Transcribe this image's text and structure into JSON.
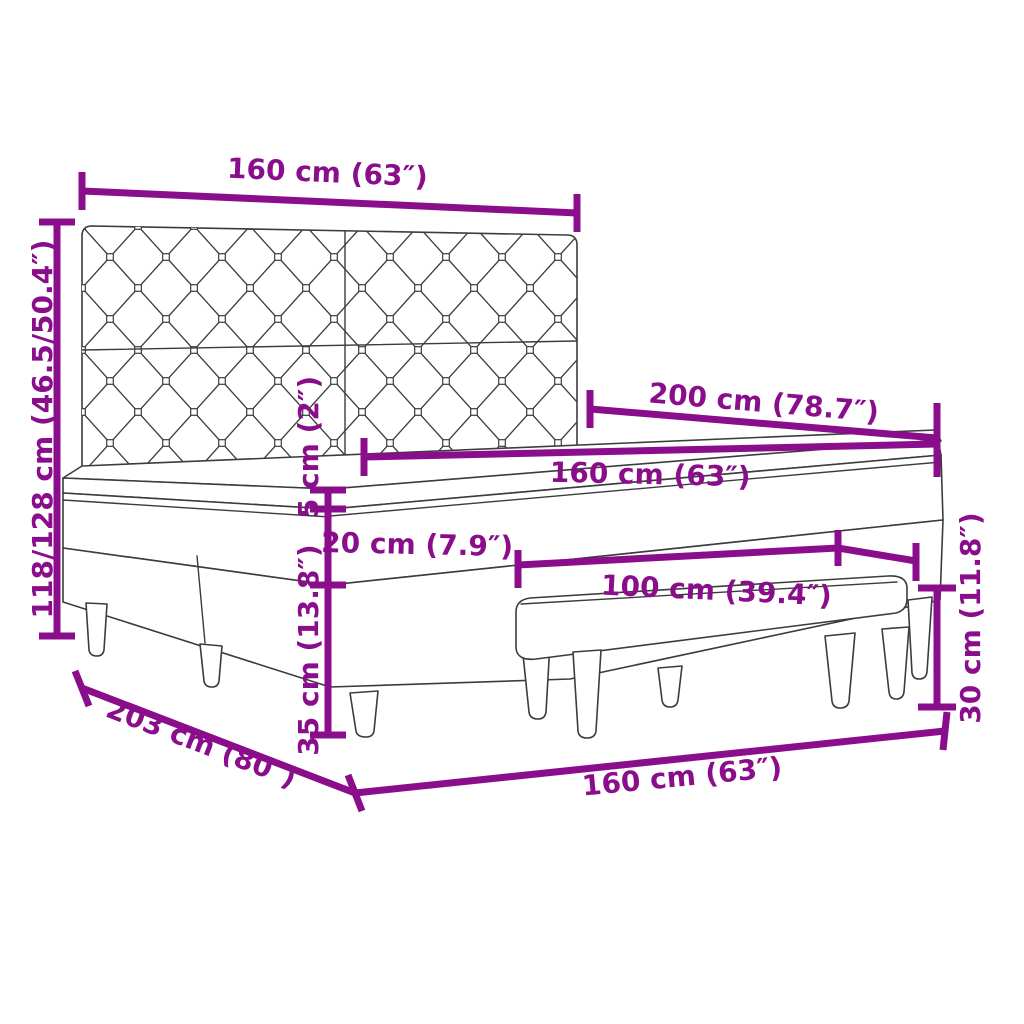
{
  "diagram": {
    "title": "Box spring bed with tufted headboard, mattress topper and bench - dimension diagram",
    "background_color": "#ffffff",
    "accent_color": "#8A0E8C",
    "line_art_color": "#3C3C3C",
    "annotations": {
      "headboard_width": "160 cm (63″)",
      "overall_height": "118/128 cm (46.5/50.4″)",
      "bed_length": "200 cm (78.7″)",
      "mattress_width": "160 cm (63″)",
      "topper_thickness": "5 cm (2″)",
      "mattress_thickness": "20 cm (7.9″)",
      "base_height": "35 cm (13.8″)",
      "bench_length": "100 cm (39.4″)",
      "bench_height": "30 cm (11.8″)",
      "frame_length": "203 cm (80″)",
      "frame_width": "160 cm (63″)"
    }
  }
}
